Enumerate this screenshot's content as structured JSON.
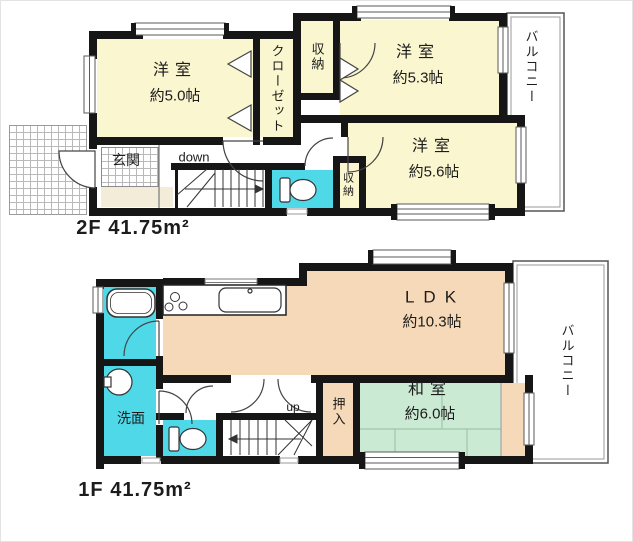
{
  "f2": {
    "floor_label": "2F 41.75m²",
    "room_a": {
      "name": "洋室",
      "size": "約5.0帖"
    },
    "room_b": {
      "name": "洋室",
      "size": "約5.3帖"
    },
    "room_c": {
      "name": "洋室",
      "size": "約5.6帖"
    },
    "closet": "クローゼット",
    "storage_top": "収納",
    "storage_side": "収納",
    "entrance": "玄関",
    "stairs": "down",
    "balcony": "バルコニー"
  },
  "f1": {
    "floor_label": "1F 41.75m²",
    "ldk": {
      "name": "LDK",
      "size": "約10.3帖"
    },
    "japanese_room": {
      "name": "和室",
      "size": "約6.0帖"
    },
    "oshiire": "押入",
    "washroom": "洗面",
    "stairs": "up",
    "balcony": "バルコニー"
  },
  "colors": {
    "wall": "#161616",
    "room_cream": "#faf6cf",
    "room_peach": "#f6d9b8",
    "room_green": "#cbead3",
    "wet_cyan": "#4fd9e8",
    "entrance_step": "#f2ecd8"
  }
}
